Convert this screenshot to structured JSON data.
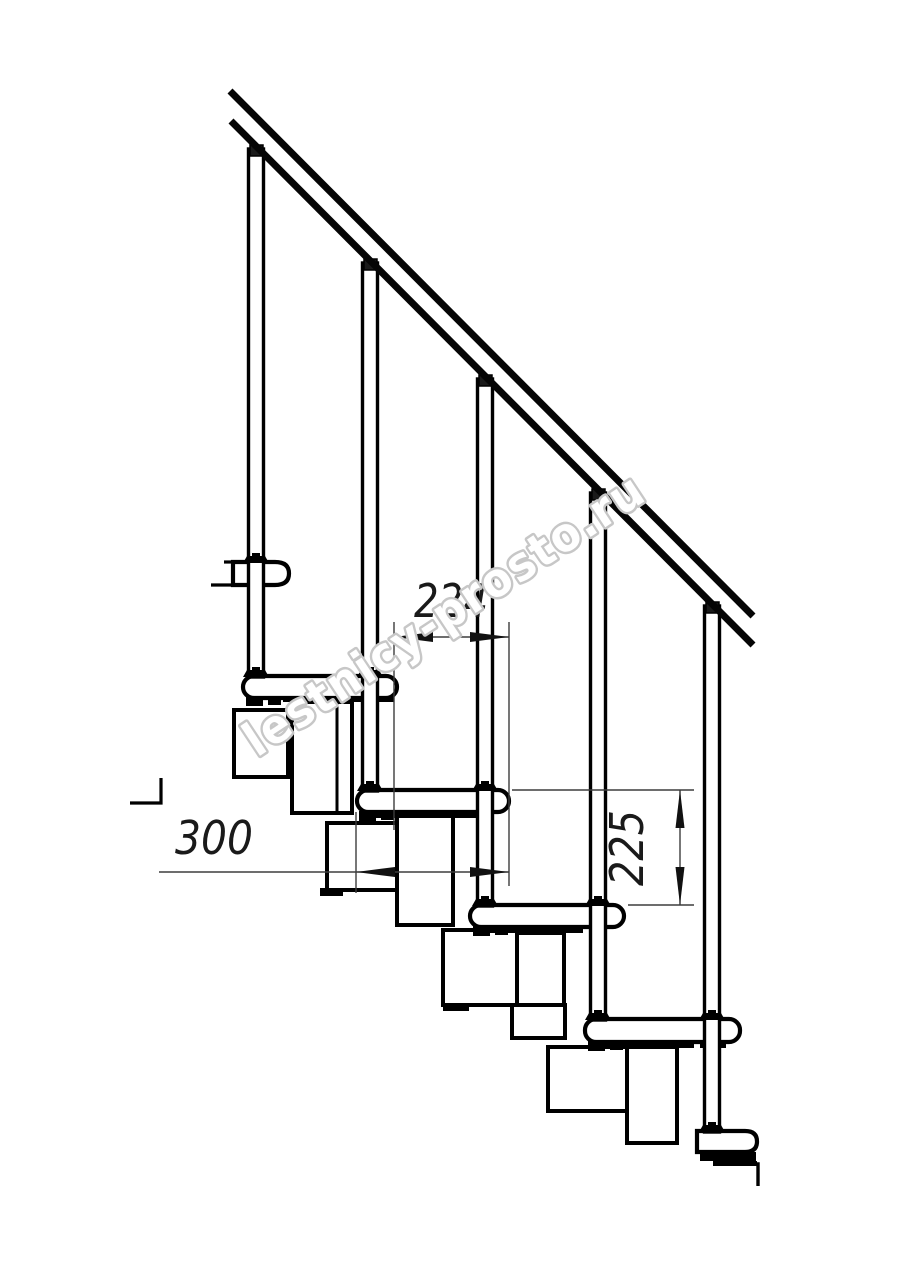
{
  "drawing": {
    "subject": "staircase-side-elevation",
    "dimensions": {
      "d224": "224",
      "d300": "300",
      "d225": "225"
    },
    "watermark": {
      "text": "lestnicy-prosto.ru",
      "color": "#c7c7c7"
    },
    "colors": {
      "line": "#000000",
      "dimension_line": "#3d3d3d",
      "background": "#ffffff"
    }
  }
}
